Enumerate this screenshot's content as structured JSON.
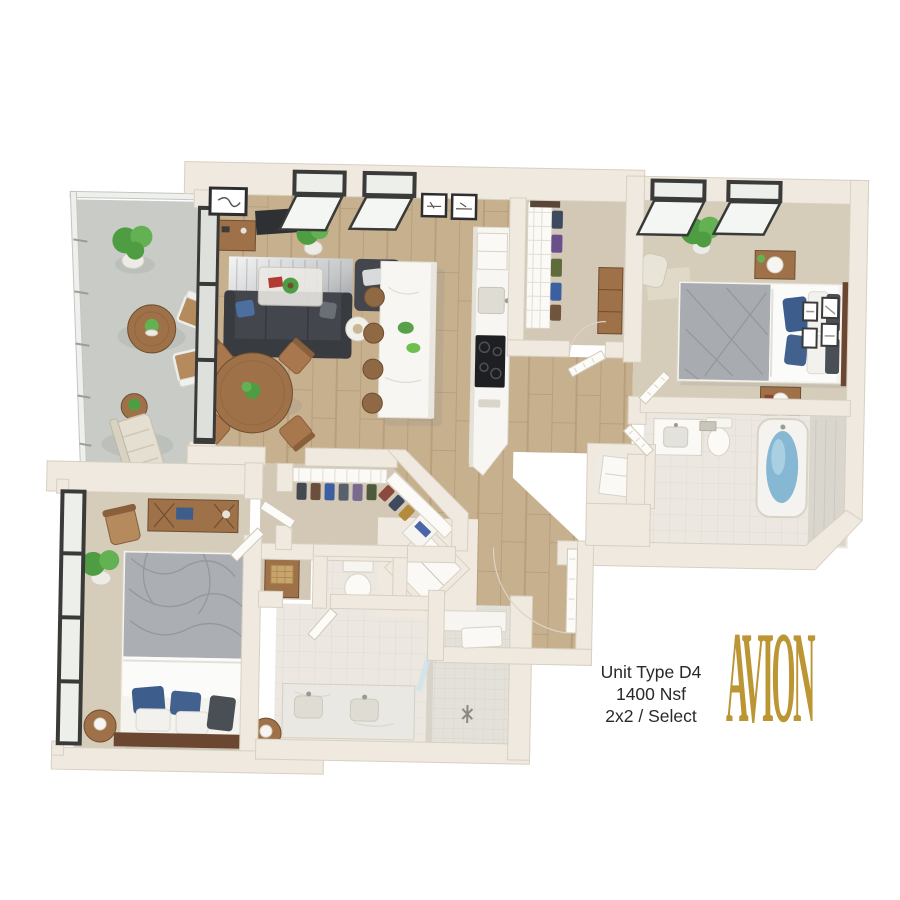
{
  "unit_info": {
    "name": "Unit Type D4",
    "area": "1400 Nsf",
    "type": "2x2 / Select"
  },
  "logo": {
    "text": "AVION"
  },
  "colors": {
    "wall": "#EFE9DF",
    "wall_edge": "#D8D0C1",
    "wood_floor": "#C7B08E",
    "wood_line": "#B49B79",
    "carpet": "#D6CCBA",
    "carpet2": "#D3C8B6",
    "bath_floor": "#ECE8E1",
    "balcony": "#C9CCC6",
    "sofa": "#43464C",
    "bed_duvet": "#A8ABAF",
    "pillow_blue": "#3D5E8C",
    "wood_furniture": "#9F7148",
    "island": "#F7F6F2",
    "water": "#86B8D3",
    "plant": "#4F9D43",
    "glass_frame": "#3A3A38",
    "gold": "#BC9634",
    "text": "#2B2826"
  }
}
